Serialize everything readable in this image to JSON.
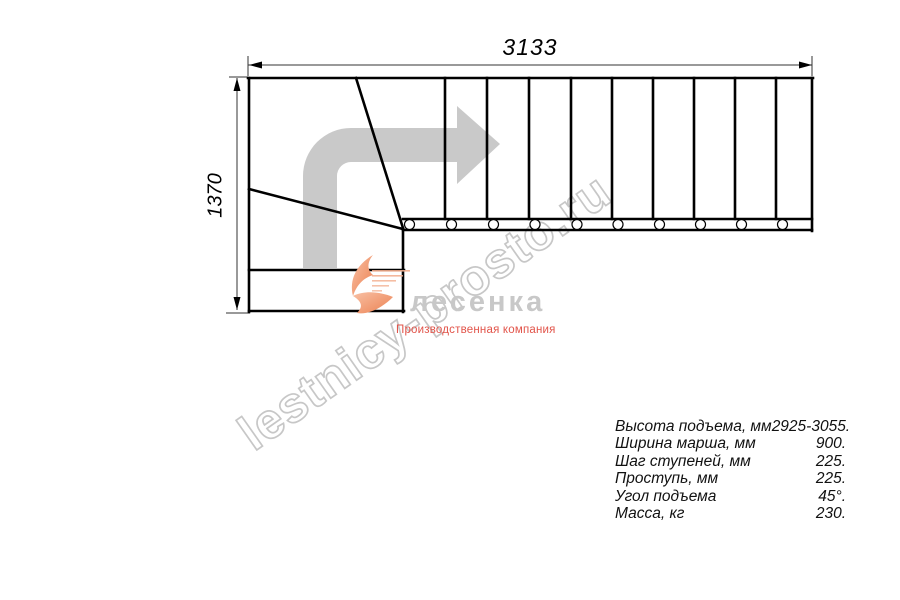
{
  "drawing": {
    "type": "staircase plan, top view, 90-degree turn left-to-right",
    "width_label": "3133",
    "height_label": "1370",
    "straight_flight_treads": 10,
    "baluster_circles": 10,
    "winder_lines": 2
  },
  "watermark": {
    "text": "lestnicy-prosto.ru",
    "color": "#c7c7c7"
  },
  "logo": {
    "name": "лесенка",
    "tagline": "Производственная компания",
    "name_color": "#c8c8c8",
    "tagline_color": "#e2544a",
    "swoosh_color": "#ef8c5f"
  },
  "specs": {
    "rows": [
      {
        "label": "Высота подъема, мм",
        "value": "2925-3055."
      },
      {
        "label": "Ширина марша, мм",
        "value": "900."
      },
      {
        "label": "Шаг ступеней, мм",
        "value": "225."
      },
      {
        "label": "Проступь, мм",
        "value": "225."
      },
      {
        "label": "Угол подъема",
        "value": "45°."
      },
      {
        "label": "Масса, кг",
        "value": "230."
      }
    ]
  },
  "colors": {
    "line": "#000000",
    "direction_arrow": "#c9c9c9",
    "background": "#ffffff"
  }
}
